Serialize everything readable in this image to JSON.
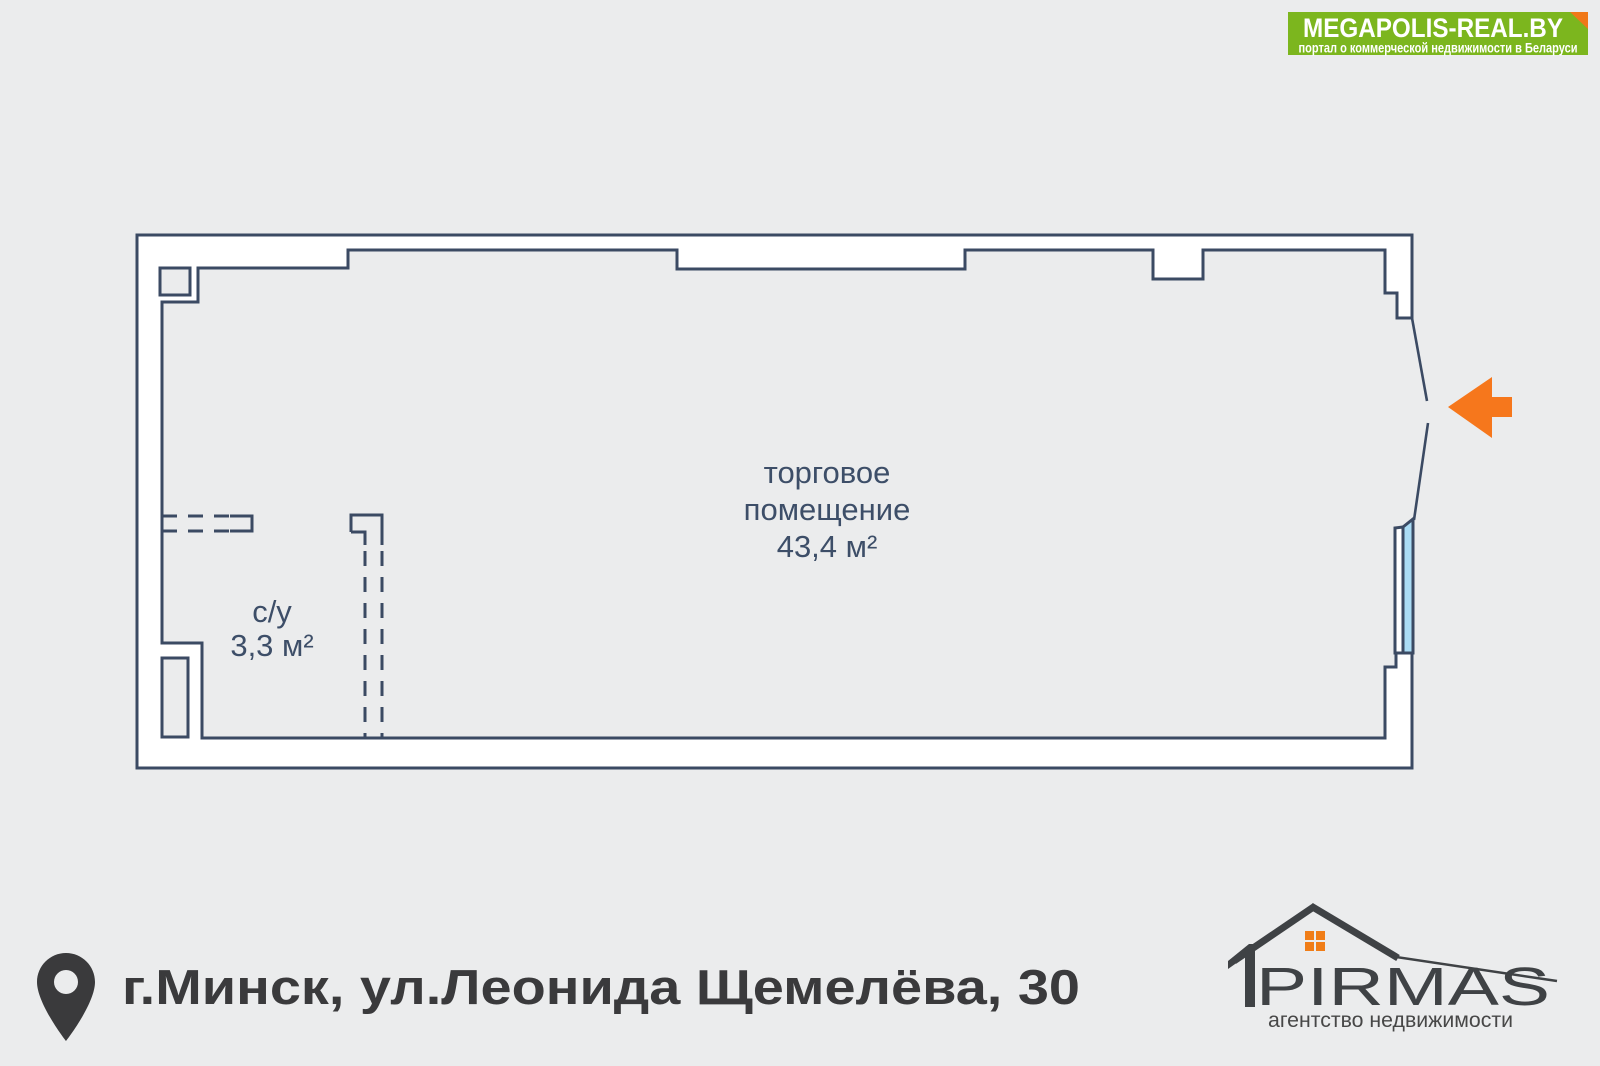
{
  "banner": {
    "title": "MEGAPOLIS-REAL.BY",
    "subtitle": "портал о коммерческой недвижимости в Беларуси"
  },
  "floor_plan": {
    "main_room": {
      "label_line1": "торговое",
      "label_line2": "помещение",
      "area": "43,4 м²"
    },
    "bathroom": {
      "name": "с/у",
      "area": "3,3 м²"
    }
  },
  "footer": {
    "address": "г.Минск, ул.Леонида Щемелёва, 30"
  },
  "agency": {
    "name": "PIRMAS",
    "tagline": "агентство недвижимости"
  },
  "colors": {
    "background": "#ebeced",
    "wall_stroke": "#3b4a63",
    "wall_fill": "#ffffff",
    "plan_text": "#3d4e68",
    "entry_arrow": "#f6771c",
    "window_glass": "#aadcf5",
    "banner_green": "#7cb61e",
    "banner_fold": "#f07818",
    "banner_text": "#ffffff",
    "footer_text": "#3a3a3c",
    "logo_dark": "#3f4245",
    "logo_window": "#f07d17"
  }
}
